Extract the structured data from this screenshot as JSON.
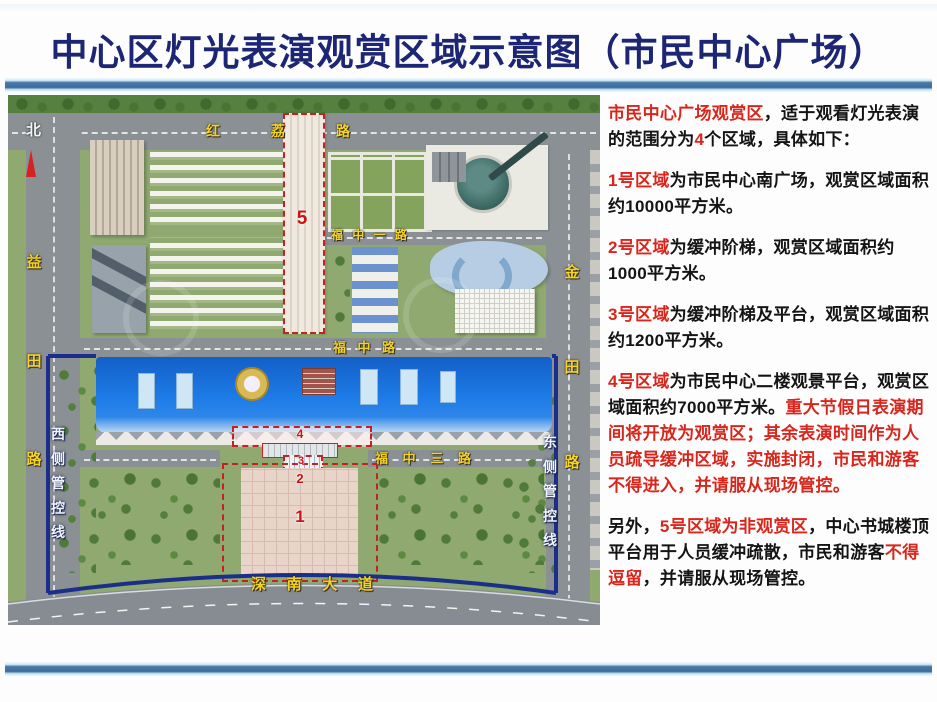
{
  "title": "中心区灯光表演观赏区域示意图（市民中心广场）",
  "colors": {
    "title_navy": "#1c2674",
    "accent_red": "#d9261c",
    "road_label_yellow": "#f7d321",
    "boundary_navy": "#1b2f8a",
    "roof_blue": "#1e7ce8"
  },
  "map": {
    "north_label": "北",
    "road_labels": {
      "honglilu": "红荔路",
      "yitianlu": "益田路",
      "jintianlu": "金田路",
      "fuzhongyilu": "福中一路",
      "fuzhonglu": "福中路",
      "fuzhongsanlu": "福中三路",
      "shennandadao": "深南大道"
    },
    "control_lines": {
      "west": "西侧管控线",
      "east": "东侧管控线"
    },
    "zones": [
      {
        "id": "1"
      },
      {
        "id": "2"
      },
      {
        "id": "3"
      },
      {
        "id": "4"
      },
      {
        "id": "5"
      }
    ]
  },
  "panel": {
    "paragraphs": [
      [
        {
          "t": "市民中心广场观赏区",
          "c": "r"
        },
        {
          "t": "，适于观看灯光表演的范围分为",
          "c": "b"
        },
        {
          "t": "4",
          "c": "r"
        },
        {
          "t": "个区域，具体如下：",
          "c": "b"
        }
      ],
      [
        {
          "t": "1号区域",
          "c": "r"
        },
        {
          "t": "为市民中心南广场，观赏区域面积约10000平方米。",
          "c": "b"
        }
      ],
      [
        {
          "t": "2号区域",
          "c": "r"
        },
        {
          "t": "为缓冲阶梯，观赏区域面积约1000平方米。",
          "c": "b"
        }
      ],
      [
        {
          "t": "3号区域",
          "c": "r"
        },
        {
          "t": "为缓冲阶梯及平台，观赏区域面积约1200平方米。",
          "c": "b"
        }
      ],
      [
        {
          "t": "4号区域",
          "c": "r"
        },
        {
          "t": "为市民中心二楼观景平台，观赏区域面积约7000平方米。",
          "c": "b"
        },
        {
          "t": "重大节假日表演期间将开放为观赏区；其余表演时间作为人员疏导缓冲区域，实施封闭，市民和游客不得进入，并请服从现场管控。",
          "c": "r"
        }
      ],
      [
        {
          "t": "另外，",
          "c": "b"
        },
        {
          "t": "5号区域为非观赏区",
          "c": "r"
        },
        {
          "t": "，中心书城楼顶平台用于人员缓冲疏散，市民和游客",
          "c": "b"
        },
        {
          "t": "不得逗留",
          "c": "r"
        },
        {
          "t": "，并请服从现场管控。",
          "c": "b"
        }
      ]
    ]
  }
}
